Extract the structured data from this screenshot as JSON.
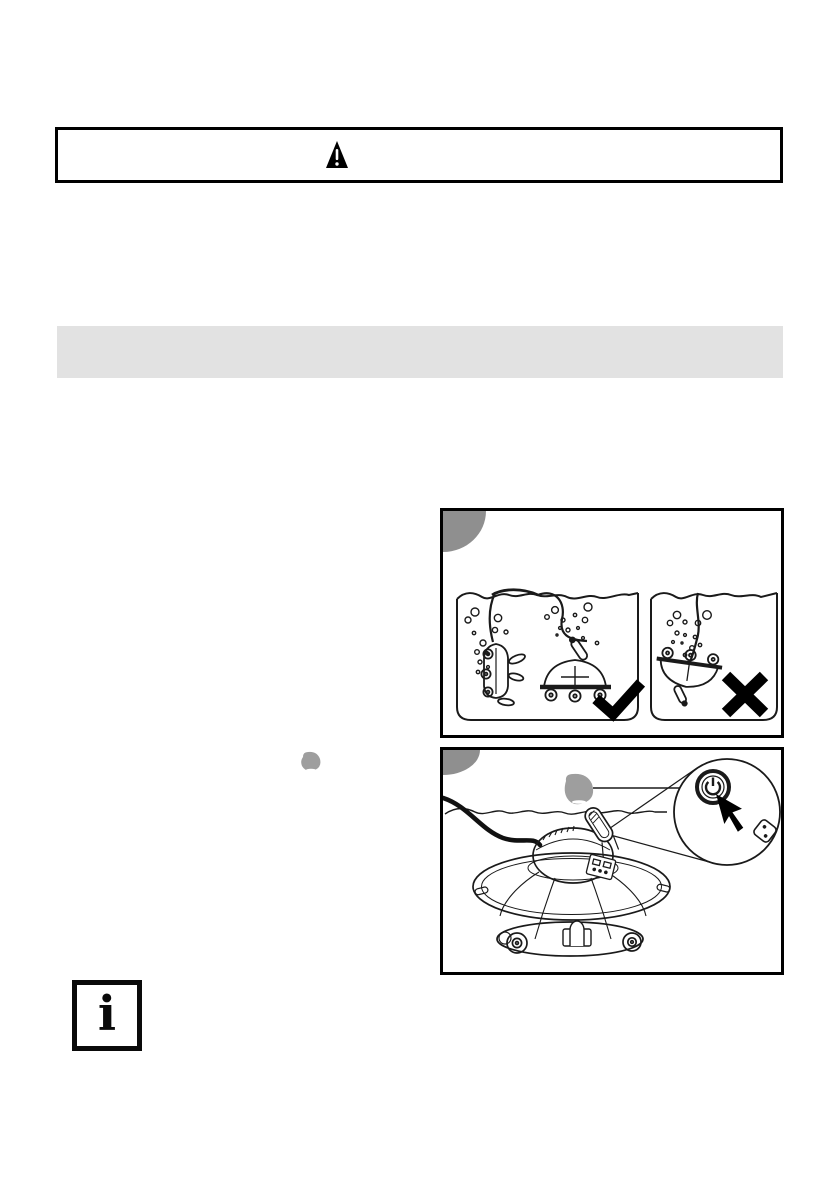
{
  "document": {
    "type": "instruction-manual-page",
    "background_color": "#ffffff"
  },
  "warning_banner": {
    "icon": "warning-triangle-icon",
    "text": ""
  },
  "section_heading_bar": {
    "text": "",
    "background_color": "#e2e2e2"
  },
  "figure_pool_placement": {
    "badge_color": "#8f8f8f",
    "correct_mark_icon": "check-icon",
    "incorrect_mark_icon": "cross-icon",
    "caption": ""
  },
  "figure_power_on": {
    "badge_color": "#8f8f8f",
    "water_drop_color": "#9e9e9e",
    "power_button_icon": "power-icon",
    "cursor_icon": "cursor-arrow-icon",
    "mode_button_icon": "dice-icon",
    "caption": ""
  },
  "inline_water_drop": {
    "color": "#9e9e9e"
  },
  "info_note": {
    "icon": "info-icon",
    "glyph": "i"
  }
}
